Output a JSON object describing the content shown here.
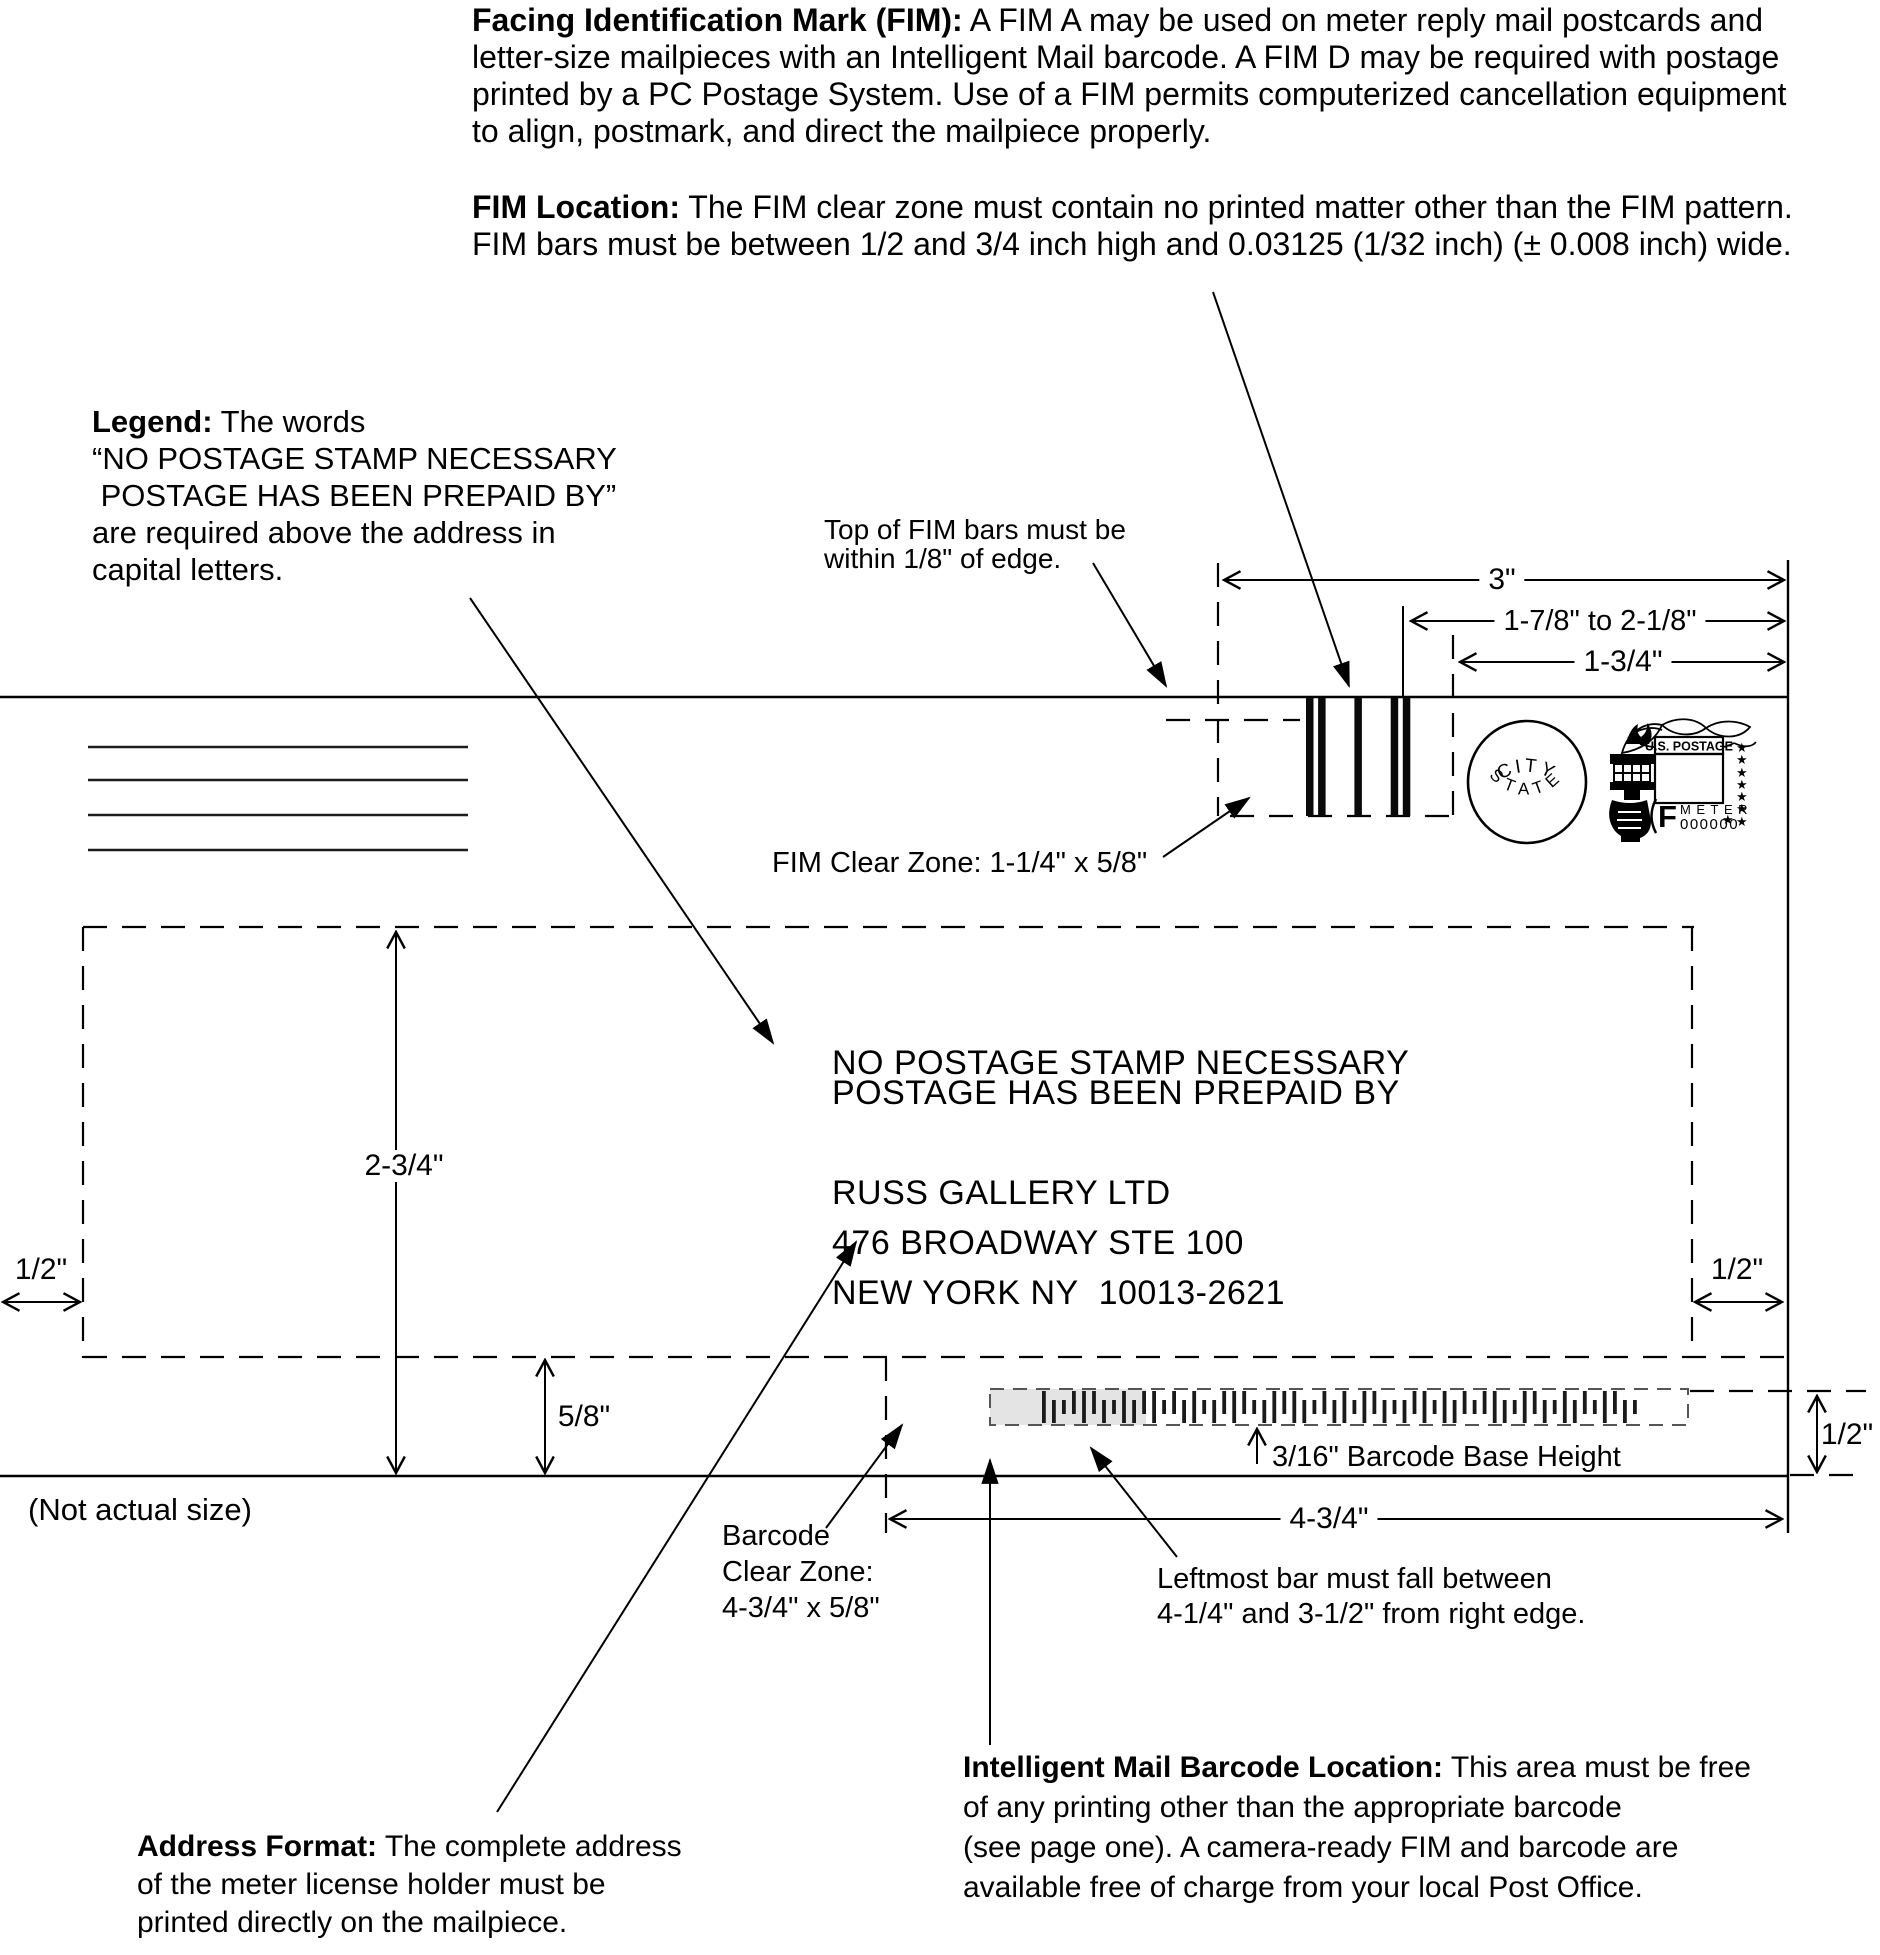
{
  "colors": {
    "ink": "#000000",
    "barcode_highlight": "#e4e4e4",
    "barcode_dash": "#555555"
  },
  "paragraphs": {
    "fim": {
      "label": "Facing Identification Mark (FIM):",
      "text": "A FIM A may be used on meter reply mail postcards and\nletter-size mailpieces with an Intelligent Mail barcode. A FIM D may be required with postage\nprinted by a PC Postage System. Use of a FIM permits computerized cancellation equipment\nto align, postmark, and direct the mailpiece properly."
    },
    "fim_location": {
      "label": "FIM Location:",
      "text": "The FIM clear zone must contain no printed matter other than the FIM pattern.\nFIM bars must be between 1/2 and 3/4 inch high and 0.03125 (1/32 inch) (± 0.008 inch) wide."
    },
    "legend": {
      "label": "Legend:",
      "text": "The words\n“NO POSTAGE STAMP NECESSARY\n POSTAGE HAS BEEN PREPAID BY”\nare required above the address in\ncapital letters."
    },
    "address_format": {
      "label": "Address Format:",
      "text": "The complete address\nof the meter license holder must be\nprinted directly on the mailpiece."
    },
    "imb_location": {
      "label": "Intelligent Mail Barcode Location:",
      "text": "This area must be free\nof any printing other than the appropriate barcode\n(see page one). A camera-ready FIM and barcode are\navailable free of charge from your local Post Office."
    }
  },
  "callouts": {
    "fim_top": "Top of FIM bars must be\nwithin 1/8\" of edge.",
    "fim_clear_zone": "FIM Clear Zone: 1-1/4\" x 5/8\"",
    "barcode_clear_zone": "Barcode\nClear Zone:\n4-3/4\" x 5/8\"",
    "leftmost_bar": "Leftmost bar must fall between\n4-1/4\" and 3-1/2\" from right edge.",
    "barcode_base_height": "3/16\" Barcode Base Height",
    "not_actual_size": "(Not actual size)"
  },
  "dimensions": {
    "three": "3\"",
    "range": "1-7/8\" to 2-1/8\"",
    "one_three_quarter": "1-3/4\"",
    "two_three_quarter": "2-3/4\"",
    "half_left": "1/2\"",
    "half_right": "1/2\"",
    "half_barcode": "1/2\"",
    "five_eighths": "5/8\"",
    "four_three_quarter": "4-3/4\""
  },
  "envelope": {
    "legend_lines": "NO POSTAGE STAMP NECESSARY\nPOSTAGE HAS BEEN PREPAID BY",
    "address": "RUSS GALLERY LTD\n476 BROADWAY STE 100\nNEW YORK NY  10013-2621",
    "postmark": {
      "top": "CITY",
      "bottom": "STATE"
    },
    "meter_stamp": {
      "header": "U.S. POSTAGE",
      "f": "F",
      "meter": "METER",
      "serial": "000000",
      "stars_column": "★\n★\n★\n★\n★\n★\n★",
      "star_extra": "★"
    },
    "fim_pattern": "110010011",
    "barcode_pattern": "FDTAFADTFDAFTADFTDAFATDFAFDTADFTFADTDAFTFDATAFDTFADTFDATFADT"
  }
}
